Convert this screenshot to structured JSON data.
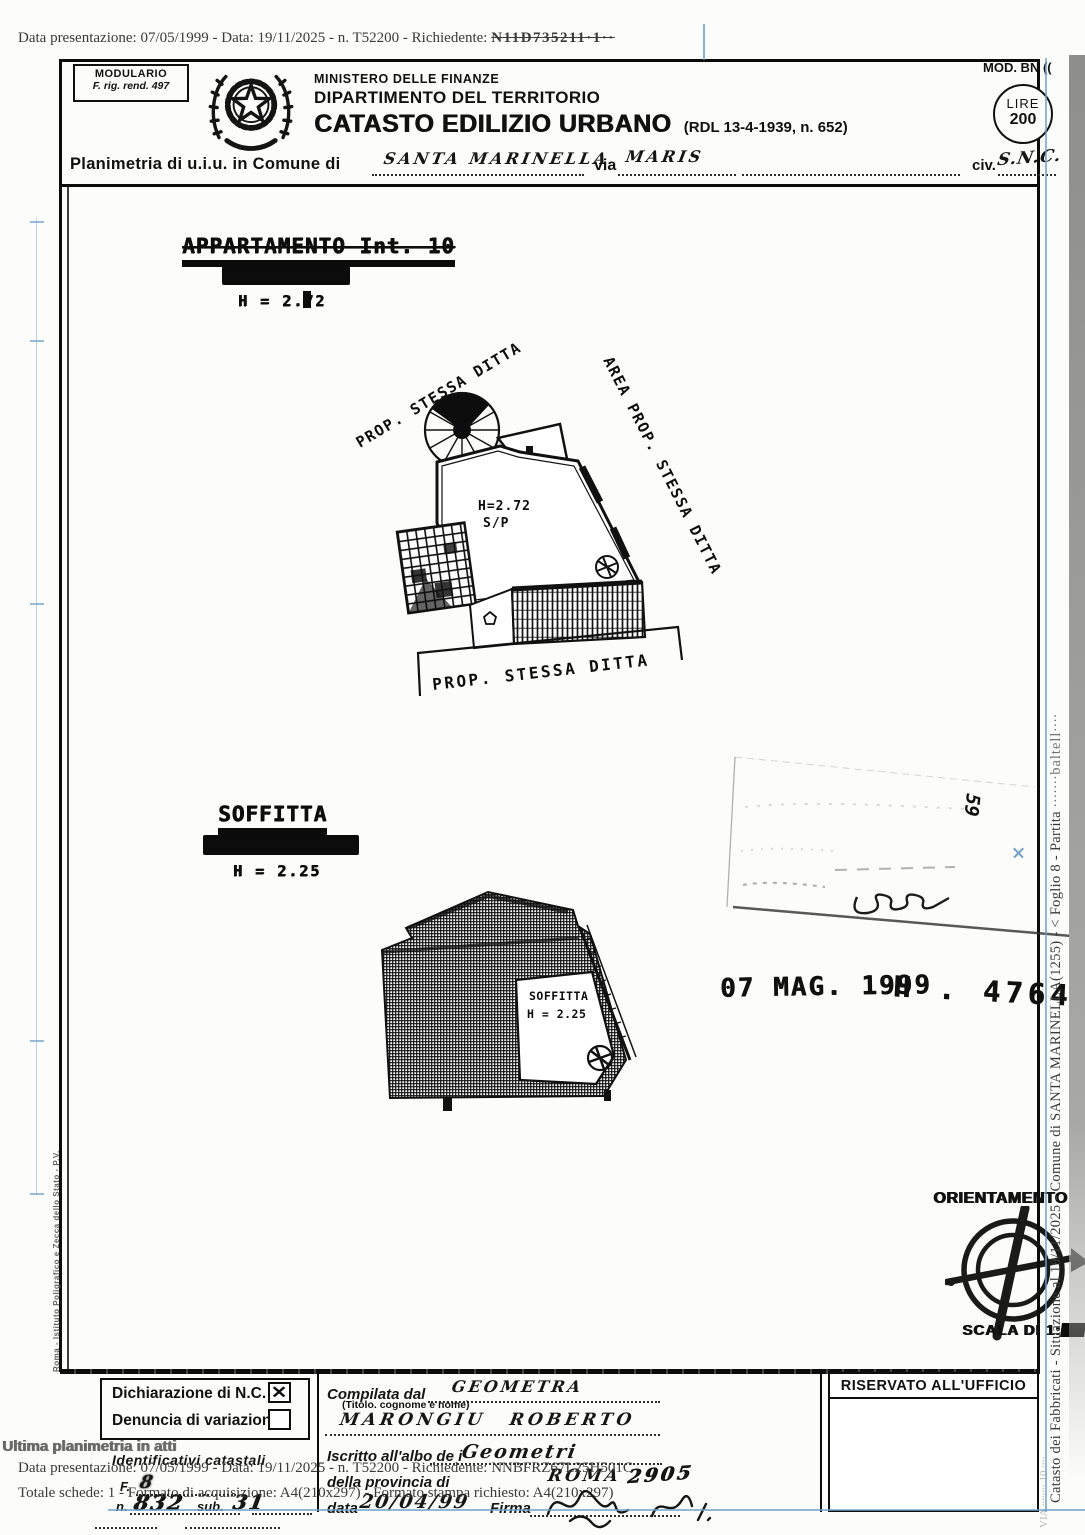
{
  "meta": {
    "top_prefix": "Data presentazione: 07/05/1999 - Data: 19/11/2025 - n. T52200 - Richiedente:",
    "top_garbled": "N11D735211·1··"
  },
  "header": {
    "modulario1": "MODULARIO",
    "modulario2": "F. rig. rend. 497",
    "ministry": "MINISTERO DELLE FINANZE",
    "department": "DIPARTIMENTO DEL TERRITORIO",
    "title": "CATASTO EDILIZIO URBANO",
    "title_suffix": "(RDL 13-4-1939, n. 652)",
    "mod_label": "MOD. BN ((",
    "lire_label": "LIRE",
    "lire_value": "200",
    "planimetria_label": "Planimetria di u.i.u. in Comune di",
    "comune_value": "SANTA MARINELLA",
    "via_label": "via",
    "via_value": "MARIS",
    "civ_label": "civ.",
    "civ_value": "S.N.C."
  },
  "plan1": {
    "title": "APPARTAMENTO Int. 10",
    "floor_obscured": "PIANO PRIMO",
    "height": "H = 2.72",
    "label_prop_top": "PROP. STESSA DITTA",
    "label_area_right": "AREA PROP. STESSA DITTA",
    "label_prop_bottom": "PROP. STESSA DITTA",
    "room_height": "H=2.72",
    "room_type": "S/P"
  },
  "plan2": {
    "title": "SOFFITTA",
    "floor_obscured": "PIANO SECONDO",
    "height": "H = 2.25",
    "room_label": "SOFFITTA",
    "room_height": "H = 2.25"
  },
  "stamp": {
    "date": "07 MAG. 1999",
    "protocol": "H . 4764",
    "side_mark": "59"
  },
  "orientation": {
    "title": "ORIENTAMENTO",
    "scale_label": "SCALA DI 1:"
  },
  "margins": {
    "left_vertical": "Roma - Istituto Poligrafico e Zecca dello Stato - P.V.",
    "right_vertical": "Catasto dei Fabbricati - Situazione al 19/11/2025 - Comune di SANTA MARINELLA(1255) - < Foglio 8 - Partita",
    "right_vertical_garble": "∙∙∙∙∙∙∙baltell∙∙∙∙",
    "right_vertical_faint": "VIA ∙∙∙∙∙∙∙∙ 10 ∙∙∙∙"
  },
  "form": {
    "dichiarazione_label": "Dichiarazione di N.C.",
    "dichiarazione_checked": "checked",
    "check_glyph": "✕",
    "denuncia_label": "Denuncia di variazione",
    "denuncia_checked": "unchecked",
    "ultima_label": "Ultima planimetria in atti",
    "identificativi_label": "Identificativi catastali",
    "f_label": "F.",
    "f_value": "8",
    "n_label": "n.",
    "n_value": "832",
    "sub_label": "sub.",
    "sub_value": "31",
    "compilata_label": "Compilata dal",
    "compilata_value": "GEOMETRA",
    "titolo_note": "(Titolo. cognome e nome)",
    "tecnico_nome": "MARONGIU ROBERTO",
    "albo_label": "Iscritto all'albo de i",
    "albo_value": "Geometri",
    "provincia_label": "della provincia di",
    "provincia_value": "ROMA",
    "albo_numero": "2905",
    "data_label": "data",
    "data_value": "20/04/99",
    "firma_label": "Firma",
    "riservato_label": "RISERVATO ALL'UFFICIO"
  },
  "watermark": {
    "line1": "Data presentazione: 07/05/1999 - Data: 19/11/2025 - n. T52200 - Richiedente: NNBFRZ67L25H501C",
    "line2": "Totale schede: 1 - Formato di acquisizione: A4(210x297) - Formato stampa richiesto: A4(210x297)"
  }
}
